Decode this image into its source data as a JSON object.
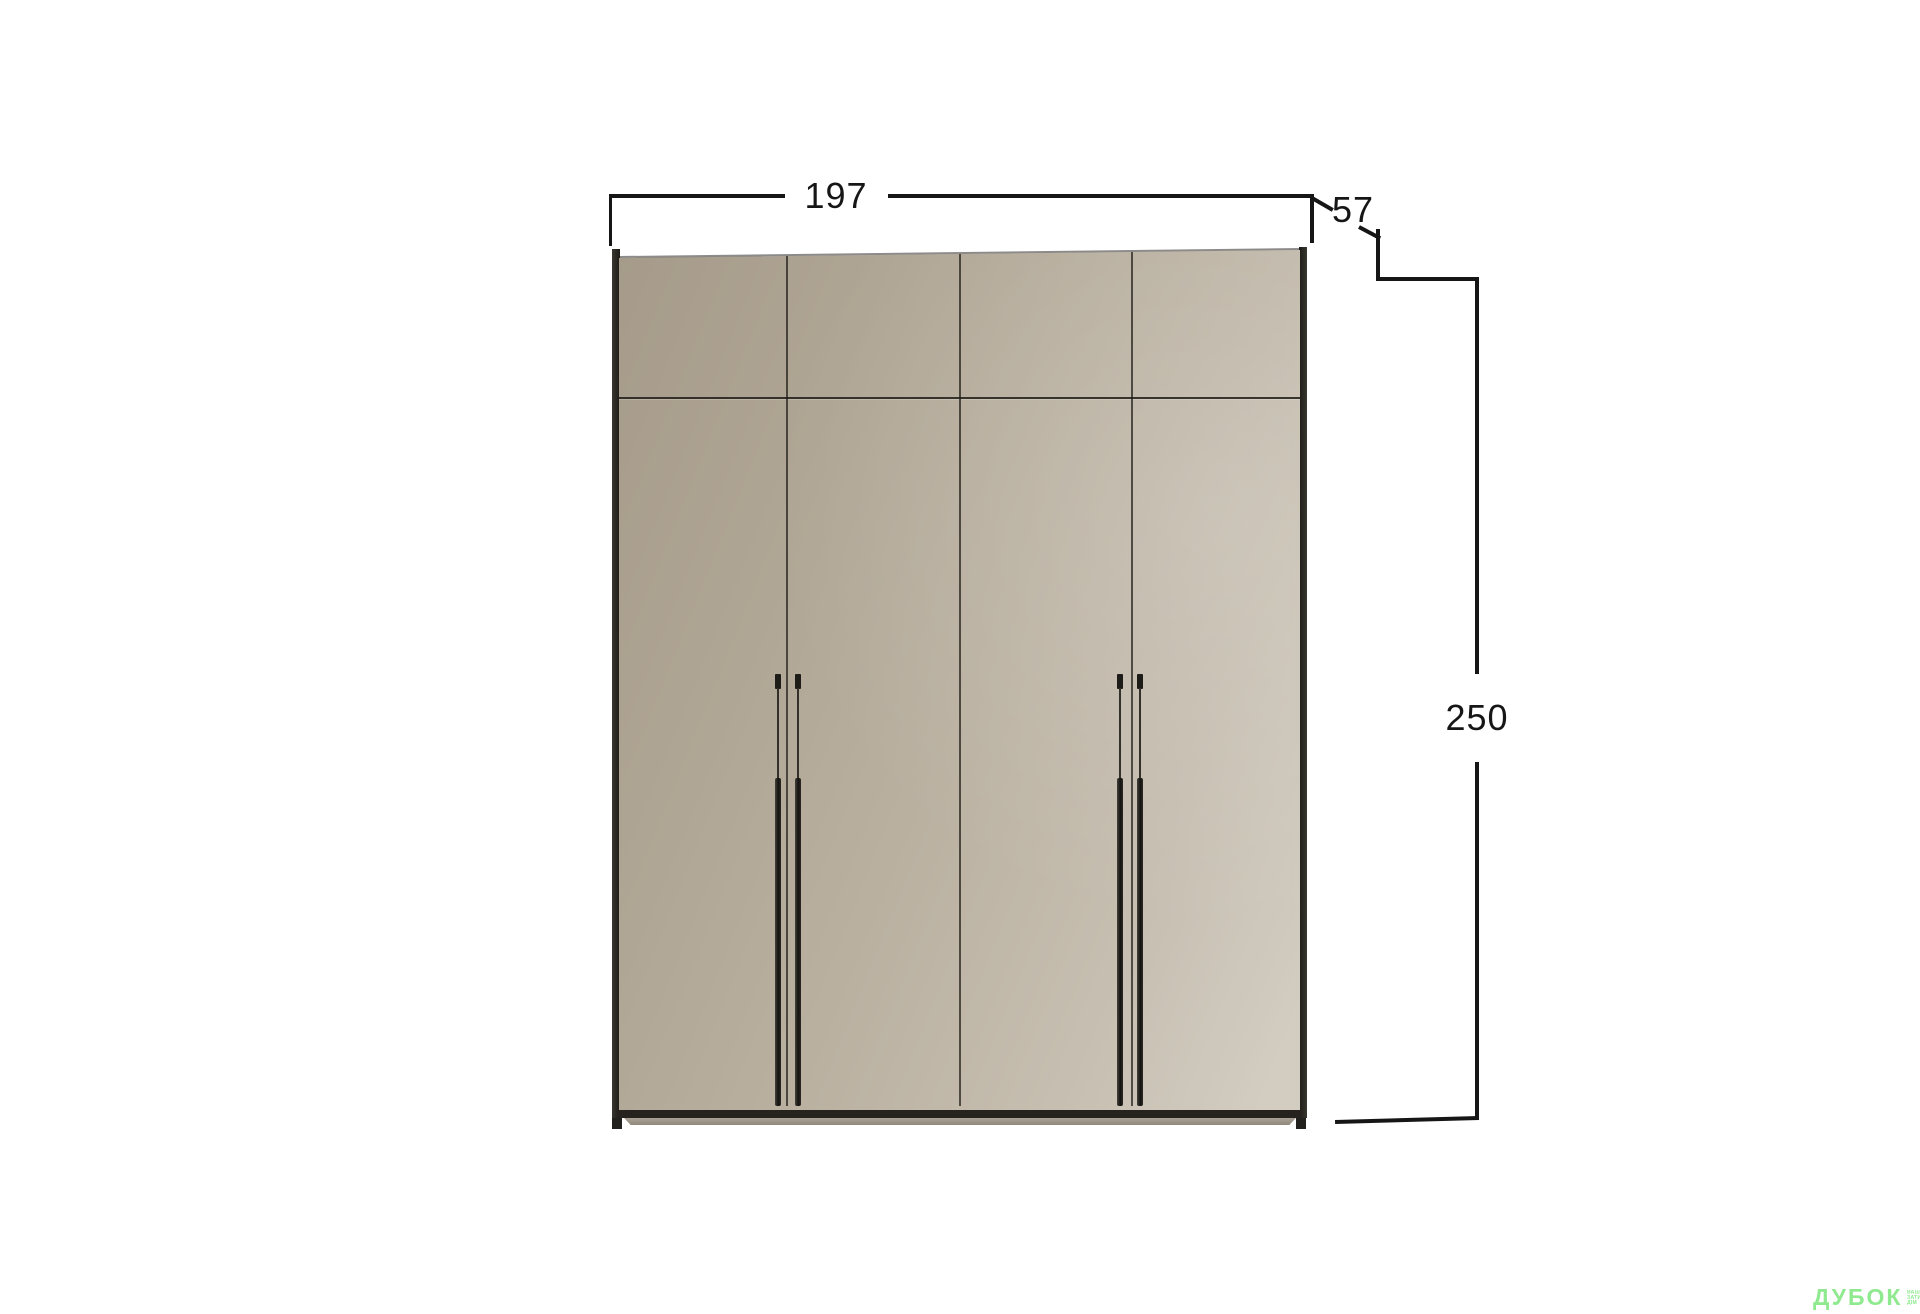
{
  "dimensions": {
    "width_label": "197",
    "depth_label": "57",
    "height_label": "250"
  },
  "wardrobe": {
    "type": "four-door wardrobe with top section",
    "doors": 4,
    "handles": 4
  },
  "colors": {
    "dim-line": "#161616",
    "face-dark": "#a69b8a",
    "face-light": "#d2ccc1",
    "edge-dark": "#1d1b18",
    "base-dark": "#26231f",
    "watermark-green": "#8fe98f",
    "background": "#ffffff"
  },
  "watermark": {
    "brand": "ДУБОК",
    "tagline_lines": [
      "ВАШ",
      "ЗАТИШНИЙ",
      "ДІМ"
    ]
  }
}
